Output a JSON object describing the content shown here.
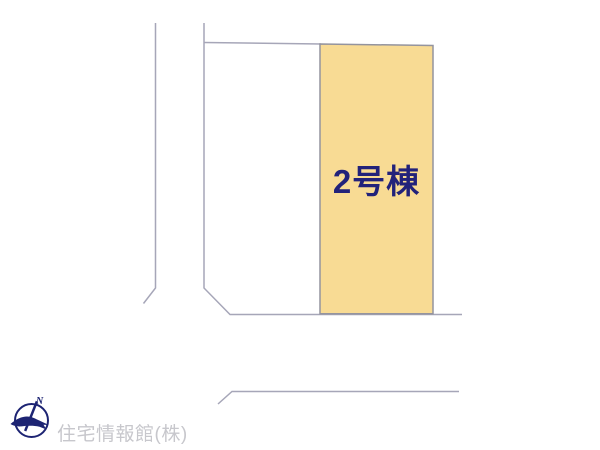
{
  "map": {
    "parcel": {
      "label": "2号棟",
      "fill_color": "#F8DB94",
      "border_color": "#94949E",
      "label_color": "#22227A"
    },
    "line_color": "#A6A6B8"
  },
  "branding": {
    "company_name": "住宅情報館(株)",
    "compass_letter": "N",
    "logo_color": "#1D2473",
    "company_text_color": "#C7C7CC"
  }
}
